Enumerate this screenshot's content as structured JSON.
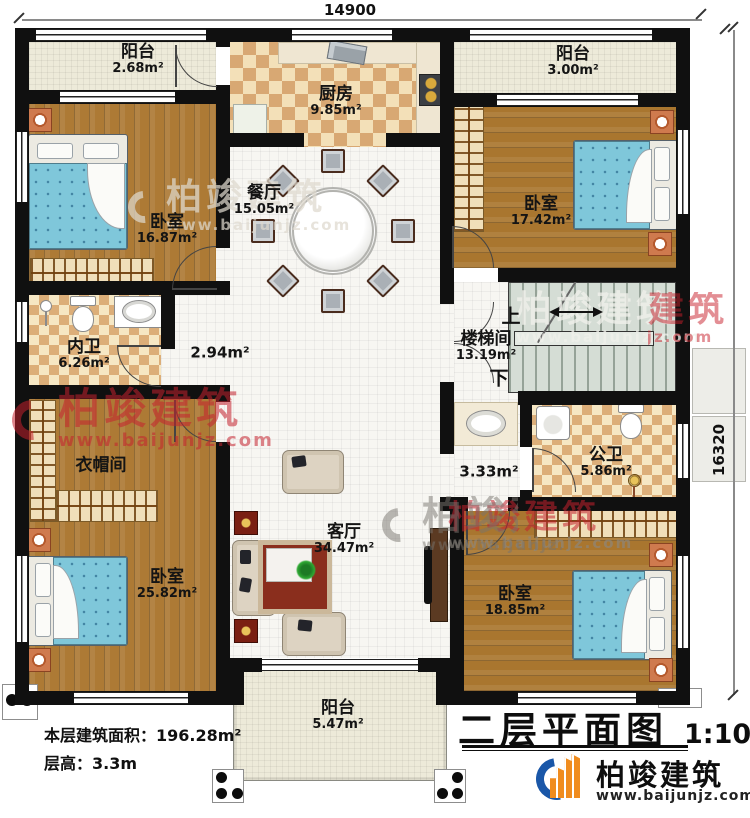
{
  "meta": {
    "title": "二层平面图",
    "scale": "1:100",
    "area_line": "本层建筑面积：196.28m²",
    "height_line": "层高：3.3m"
  },
  "dimensions": {
    "top": "14900",
    "right": "16320"
  },
  "brand": {
    "name": "柏竣建筑",
    "site": "www.baijunjz.com"
  },
  "watermark": {
    "brand": "柏竣建筑",
    "site": "www.baijunjz.com"
  },
  "rooms": [
    {
      "id": "balcony-top-left",
      "name": "阳台",
      "area": "2.68m²"
    },
    {
      "id": "kitchen",
      "name": "厨房",
      "area": "9.85m²"
    },
    {
      "id": "balcony-top-right",
      "name": "阳台",
      "area": "3.00m²"
    },
    {
      "id": "bedroom-top-left",
      "name": "卧室",
      "area": "16.87m²"
    },
    {
      "id": "dining",
      "name": "餐厅",
      "area": "15.05m²"
    },
    {
      "id": "bedroom-top-right",
      "name": "卧室",
      "area": "17.42m²"
    },
    {
      "id": "stairwell",
      "name": "楼梯间",
      "area": "13.19m²",
      "up": "上",
      "down": "下"
    },
    {
      "id": "inner-bath",
      "name": "内卫",
      "area": "6.26m²"
    },
    {
      "id": "hallway-small",
      "name": "",
      "area": "2.94m²"
    },
    {
      "id": "cloakroom",
      "name": "衣帽间",
      "area": ""
    },
    {
      "id": "public-bath",
      "name": "公卫",
      "area": "5.86m²"
    },
    {
      "id": "hallway-east",
      "name": "",
      "area": "3.33m²"
    },
    {
      "id": "living",
      "name": "客厅",
      "area": "34.47m²"
    },
    {
      "id": "bedroom-bottom-left",
      "name": "卧室",
      "area": "25.82m²"
    },
    {
      "id": "bedroom-bottom-right",
      "name": "卧室",
      "area": "18.85m²"
    },
    {
      "id": "balcony-bottom",
      "name": "阳台",
      "area": "5.47m²"
    }
  ],
  "colors": {
    "wall": "#101010",
    "wood": "#ad7a35",
    "watermark_red": "#c4222d",
    "logo_blue": "#1a57a8",
    "logo_orange": "#f08c1e"
  }
}
